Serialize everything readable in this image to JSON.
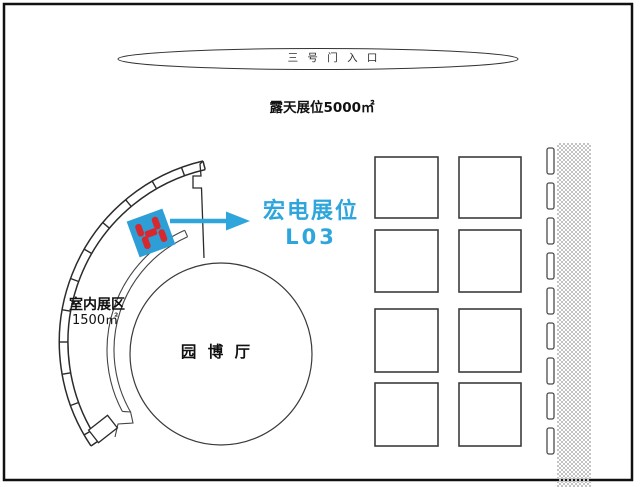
{
  "diagram": {
    "title_context": "exhibition-floor-plan",
    "entrance": {
      "label": "三 号 门 入 口"
    },
    "open_air": {
      "label": "露天展位5000㎡"
    },
    "highlight_callout": {
      "name": "宏电展位",
      "booth_no": "L03"
    },
    "indoor_zone": {
      "label": "室内展区",
      "area": "1500㎡"
    },
    "hall": {
      "label": "园 博 厅"
    }
  },
  "colors": {
    "accent_cyan": "#2ea6dc",
    "booth_fill": "#2d9fd6",
    "logo_red": "#d7282f",
    "line_black": "#1a1a1a",
    "hatch_gray": "#c3c3c3"
  }
}
